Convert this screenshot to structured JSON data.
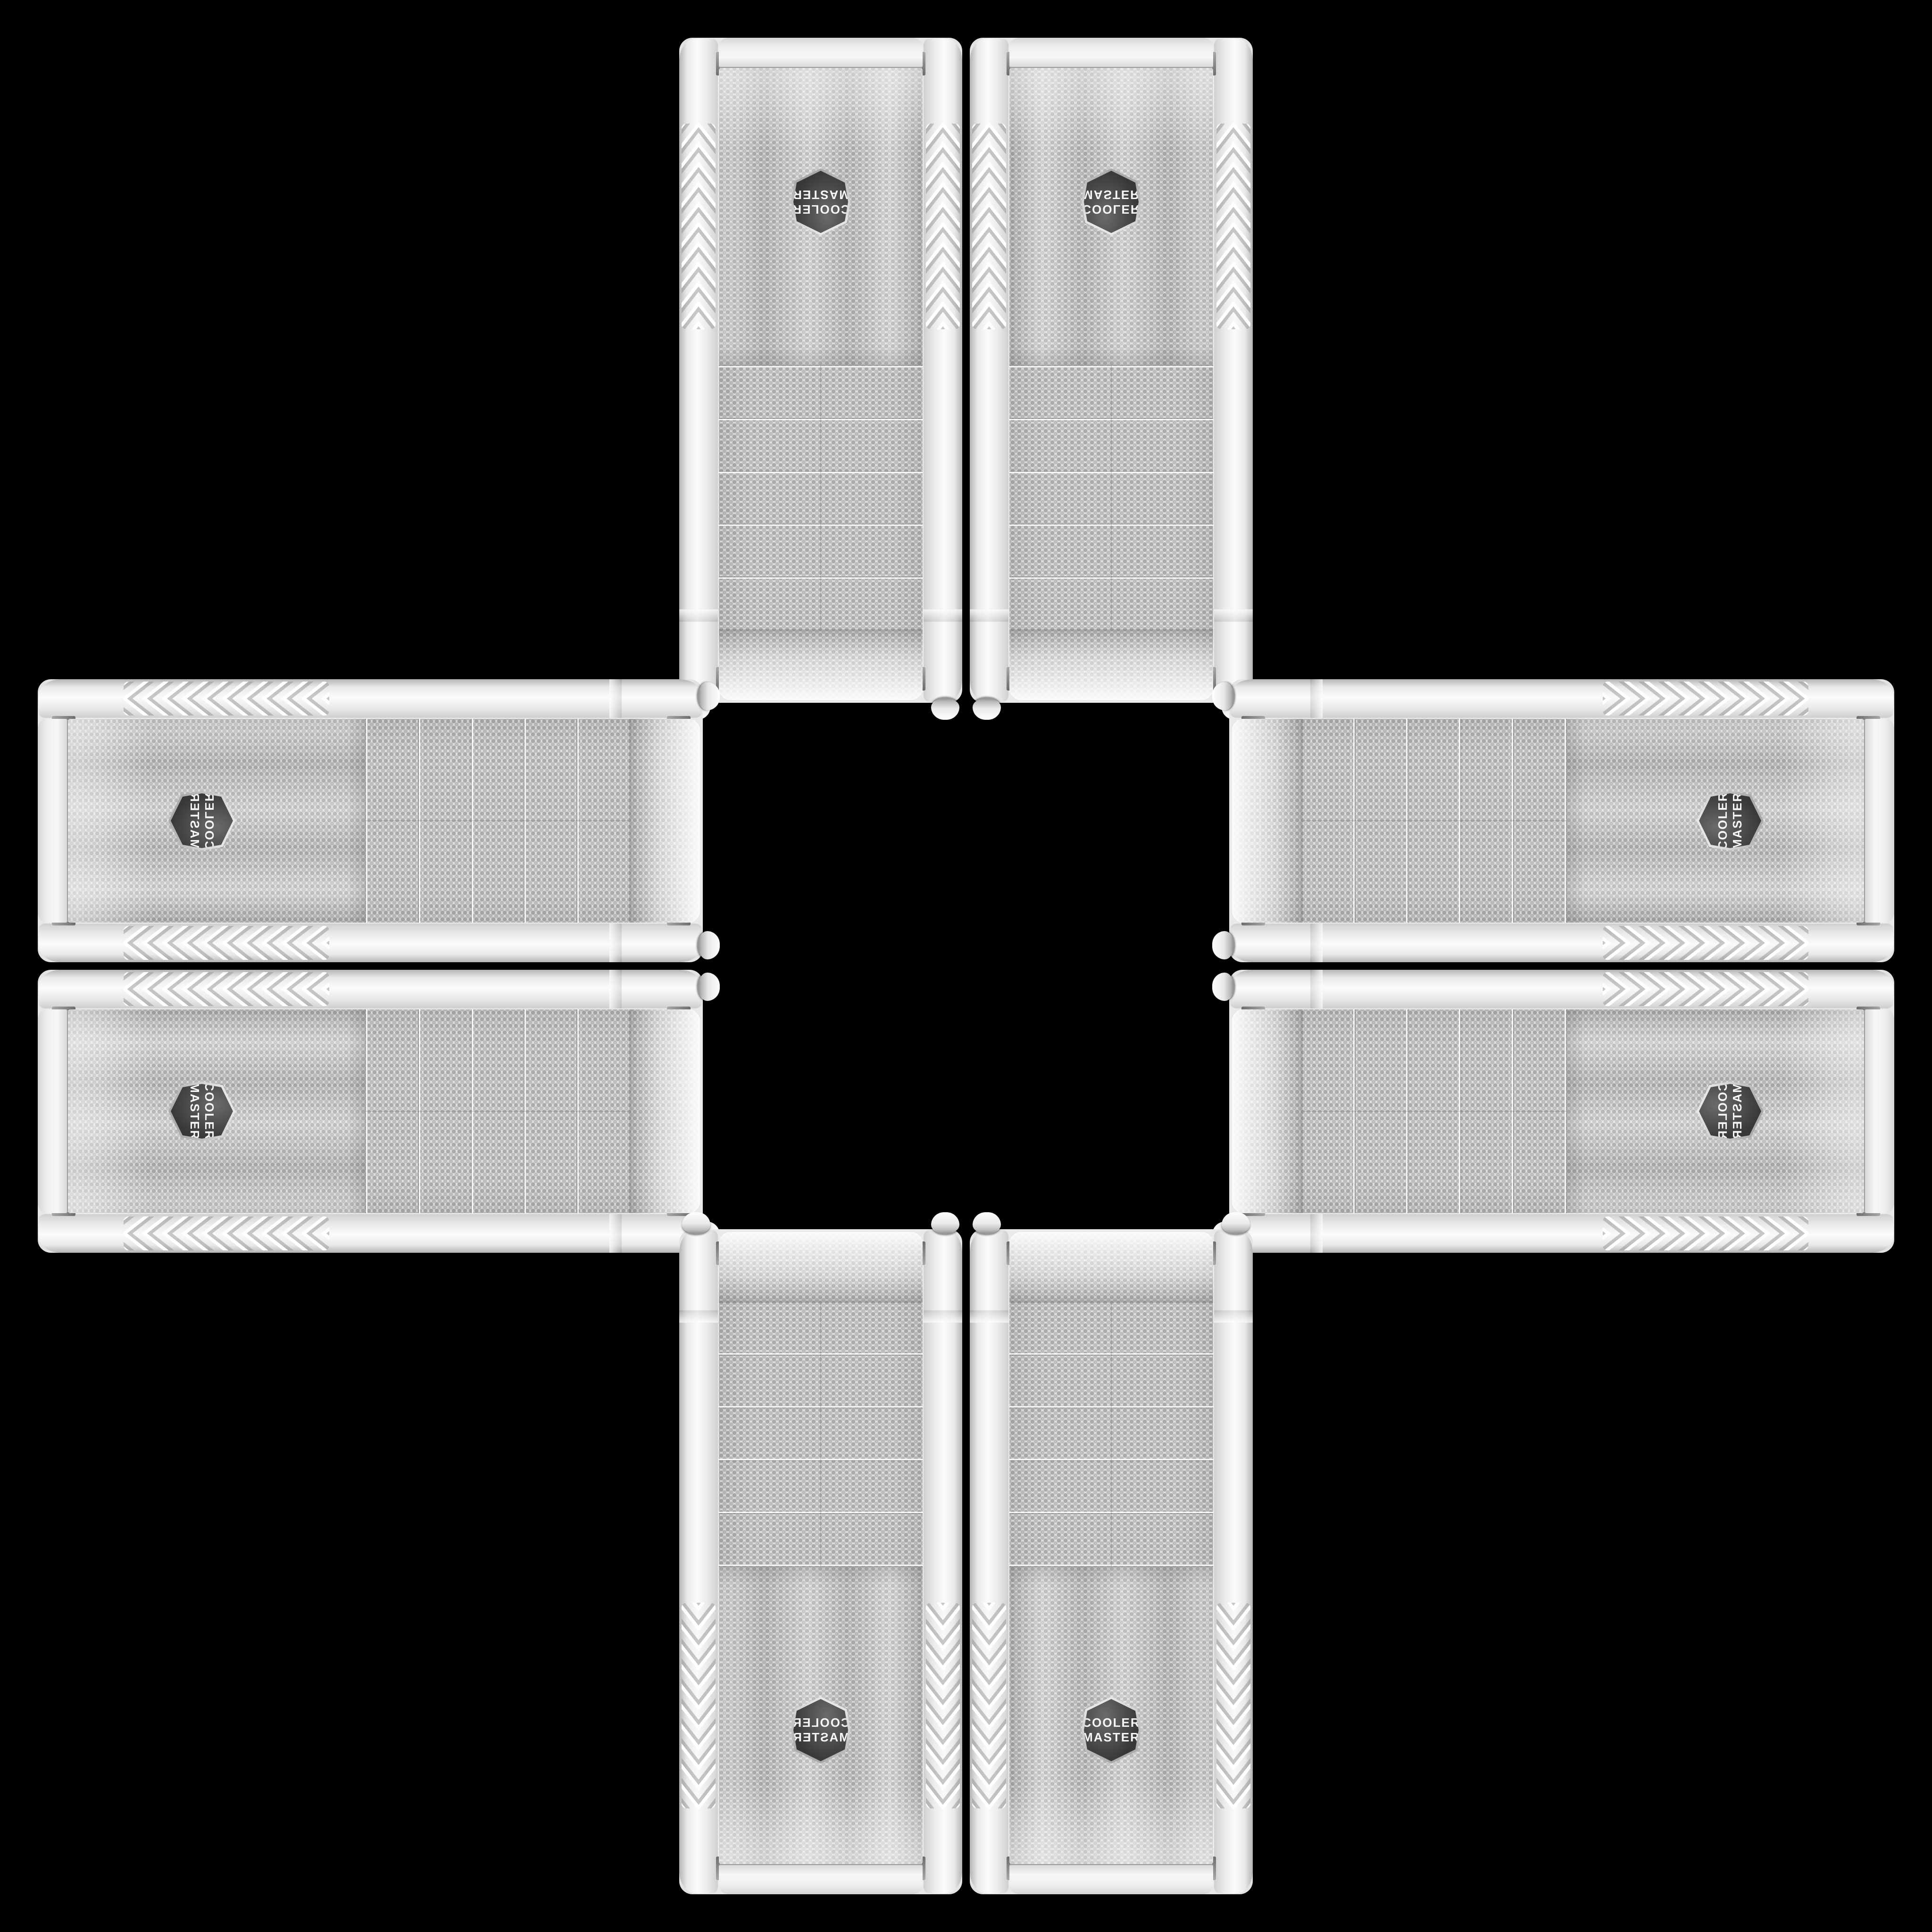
{
  "scene": {
    "background_color": "#000000",
    "tile_count": 8,
    "product": {
      "brand_line1": "COOLER",
      "brand_line2": "MASTER",
      "palette": {
        "body_white": "#f2f2f2",
        "rail_highlight": "#fbfbfb",
        "rail_shadow": "#bdbdbd",
        "mesh_base": "#e2e2e2",
        "mesh_dot": "#ababab",
        "seam": "#8e8e8e",
        "chrome_pin": "#757575",
        "badge_background": "#3b3b3b",
        "badge_rim": "#e8e8e8",
        "badge_text": "#f8f8f8"
      }
    },
    "tiles": [
      {
        "id": "tl",
        "position": "top-left",
        "orientation": "rotated-180"
      },
      {
        "id": "tr",
        "position": "top-right",
        "orientation": "flipped-vertical"
      },
      {
        "id": "lt",
        "position": "left-top",
        "orientation": "rotated-90-flipped"
      },
      {
        "id": "lb",
        "position": "left-bottom",
        "orientation": "rotated-90"
      },
      {
        "id": "rt",
        "position": "right-top",
        "orientation": "rotated-270"
      },
      {
        "id": "rb",
        "position": "right-bottom",
        "orientation": "rotated-90-mirrored"
      },
      {
        "id": "bl",
        "position": "bottom-left",
        "orientation": "flipped-horizontal"
      },
      {
        "id": "br",
        "position": "bottom-right",
        "orientation": "upright"
      }
    ]
  }
}
